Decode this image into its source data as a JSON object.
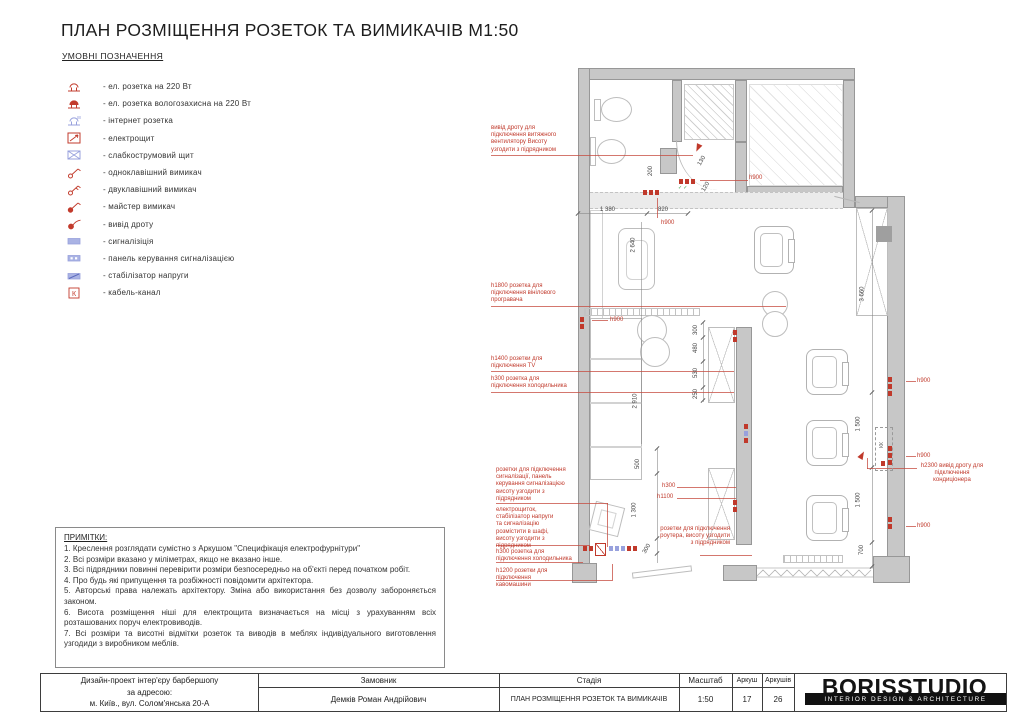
{
  "title": "ПЛАН РОЗМІЩЕННЯ РОЗЕТОК ТА ВИМИКАЧІВ М1:50",
  "legend": {
    "title": "УМОВНІ ПОЗНАЧЕННЯ",
    "items": [
      {
        "icon": "socket-220-icon",
        "label": "- ел. розетка на 220 Вт"
      },
      {
        "icon": "socket-waterproof-icon",
        "label": "- ел. розетка вологозахисна на 220 Вт"
      },
      {
        "icon": "internet-socket-icon",
        "label": "- інтернет розетка"
      },
      {
        "icon": "electrical-panel-icon",
        "label": "- електрощит"
      },
      {
        "icon": "low-current-panel-icon",
        "label": "- слабкострумовий щит"
      },
      {
        "icon": "single-switch-icon",
        "label": "- одноклавішний вимикач"
      },
      {
        "icon": "double-switch-icon",
        "label": "- двуклавішний вимикач"
      },
      {
        "icon": "master-switch-icon",
        "label": "- майстер вимикач"
      },
      {
        "icon": "wire-outlet-icon",
        "label": "- вивід дроту"
      },
      {
        "icon": "alarm-icon",
        "label": "- сигналізіція"
      },
      {
        "icon": "alarm-control-panel-icon",
        "label": "- панель керування сигналізацією"
      },
      {
        "icon": "voltage-stabilizer-icon",
        "label": "- стабілізатор напруги"
      },
      {
        "icon": "cable-channel-icon",
        "label": "- кабель-канал"
      }
    ]
  },
  "notes": {
    "title": "ПРИМІТКИ:",
    "lines": [
      "1. Креслення розглядати сумістно з Аркушом \"Специфікація електрофурнітури\"",
      "2. Всі розміри вказано у міліметрах, якщо не вказано інше.",
      "3. Всі підрядники повинні перевірити розміри безпосередньо на об'єкті перед початком робіт.",
      "4. Про будь які припущення та розбіжності повідомити архітектора.",
      "5. Авторські права належать архітектору. Зміна або використання без дозволу забороняється законом.",
      "6. Висота розміщення ніші для електрощита визначається на місці з урахуванням всіх розташованих поруч електровиводів.",
      "7. Всі розміри та висотні відмітки розеток та виводів в меблях індивідуального виготовлення узгодиди з виробником меблів."
    ]
  },
  "plan": {
    "accent_red": "#c0392b",
    "accent_blue": "#98a1dd",
    "kk_label": "КК",
    "dim_labels": [
      {
        "t": "1 380",
        "x": 600,
        "y": 207,
        "r": 0
      },
      {
        "t": "820",
        "x": 658,
        "y": 207,
        "r": 0
      },
      {
        "t": "200",
        "x": 646,
        "y": 168,
        "r": -90
      },
      {
        "t": "130",
        "x": 697,
        "y": 158,
        "r": -60
      },
      {
        "t": "120",
        "x": 701,
        "y": 184,
        "r": -60
      },
      {
        "t": "2 640",
        "x": 626,
        "y": 242,
        "r": -90
      },
      {
        "t": "2 910",
        "x": 628,
        "y": 398,
        "r": -90
      },
      {
        "t": "300",
        "x": 691,
        "y": 327,
        "r": -90
      },
      {
        "t": "480",
        "x": 691,
        "y": 345,
        "r": -90
      },
      {
        "t": "530",
        "x": 691,
        "y": 370,
        "r": -90
      },
      {
        "t": "250",
        "x": 691,
        "y": 391,
        "r": -90
      },
      {
        "t": "500",
        "x": 633,
        "y": 461,
        "r": -90
      },
      {
        "t": "1 300",
        "x": 627,
        "y": 507,
        "r": -90
      },
      {
        "t": "300",
        "x": 642,
        "y": 546,
        "r": -60
      },
      {
        "t": "3 660",
        "x": 855,
        "y": 291,
        "r": -90
      },
      {
        "t": "1 500",
        "x": 851,
        "y": 421,
        "r": -90
      },
      {
        "t": "1 500",
        "x": 851,
        "y": 497,
        "r": -90
      },
      {
        "t": "700",
        "x": 857,
        "y": 547,
        "r": -90
      }
    ],
    "red_labels": [
      {
        "t": "h900",
        "x": 749,
        "y": 175
      },
      {
        "t": "h900",
        "x": 661,
        "y": 220
      },
      {
        "t": "h900",
        "x": 610,
        "y": 317
      },
      {
        "t": "h900",
        "x": 917,
        "y": 378
      },
      {
        "t": "h900",
        "x": 917,
        "y": 453
      },
      {
        "t": "h900",
        "x": 917,
        "y": 523
      },
      {
        "t": "h300",
        "x": 662,
        "y": 483
      },
      {
        "t": "h1100",
        "x": 657,
        "y": 494
      }
    ],
    "annotations": [
      {
        "t": "вивід дроту для підключення витяжного вентилятору Висоту узгодити з підрядником",
        "x": 491,
        "y": 125,
        "w": 80,
        "a": "left"
      },
      {
        "t": "h1800 розетка для підключення вінілового програвача",
        "x": 491,
        "y": 283,
        "w": 75,
        "a": "left"
      },
      {
        "t": "h1400 розетки для підключення TV",
        "x": 491,
        "y": 356,
        "w": 75,
        "a": "left"
      },
      {
        "t": "h300 розетка для підключення холодильника",
        "x": 491,
        "y": 376,
        "w": 79,
        "a": "left"
      },
      {
        "t": "розетки для підключення сигналізації, панель керування сигналізацією висоту узгодити з підрядником",
        "x": 496,
        "y": 467,
        "w": 70,
        "a": "left"
      },
      {
        "t": "електрощиток, стабілізатор напруги та сигналізацію розмістити в шафі, висоту узгодити з підрядником",
        "x": 496,
        "y": 507,
        "w": 62,
        "a": "left"
      },
      {
        "t": "h300 розетка для підключення холодильника",
        "x": 496,
        "y": 549,
        "w": 79,
        "a": "left"
      },
      {
        "t": "h1200 розетки для підключення кавомашини",
        "x": 496,
        "y": 568,
        "w": 68,
        "a": "left"
      },
      {
        "t": "розетки для підключення роутера, висоту узгодити з підрядником",
        "x": 656,
        "y": 526,
        "w": 74,
        "a": "right"
      },
      {
        "t": "h2300 вивід дроту для підключення кондиціонера",
        "x": 920,
        "y": 463,
        "w": 64,
        "a": "center"
      }
    ],
    "leaders": [
      {
        "x": 491,
        "y": 155,
        "w": 202
      },
      {
        "x": 700,
        "y": 180,
        "w": 48
      },
      {
        "x": 657,
        "y": 198,
        "h": 20
      },
      {
        "x": 592,
        "y": 320,
        "w": 16
      },
      {
        "x": 491,
        "y": 306,
        "w": 295
      },
      {
        "x": 491,
        "y": 371,
        "w": 243
      },
      {
        "x": 491,
        "y": 392,
        "w": 243
      },
      {
        "x": 496,
        "y": 503,
        "w": 112
      },
      {
        "x": 607,
        "y": 503,
        "h": 44
      },
      {
        "x": 496,
        "y": 545,
        "w": 93
      },
      {
        "x": 589,
        "y": 545,
        "h": 6
      },
      {
        "x": 496,
        "y": 562,
        "w": 87
      },
      {
        "x": 496,
        "y": 580,
        "w": 117
      },
      {
        "x": 612,
        "y": 564,
        "h": 16
      },
      {
        "x": 677,
        "y": 487,
        "w": 59
      },
      {
        "x": 677,
        "y": 498,
        "w": 59
      },
      {
        "x": 700,
        "y": 555,
        "w": 52
      },
      {
        "x": 906,
        "y": 381,
        "w": 10
      },
      {
        "x": 906,
        "y": 456,
        "w": 10
      },
      {
        "x": 906,
        "y": 526,
        "w": 10
      },
      {
        "x": 867,
        "y": 468,
        "w": 50
      },
      {
        "x": 867,
        "y": 458,
        "h": 11
      }
    ],
    "dim_lines": [
      {
        "x": 578,
        "y": 213,
        "w": 110
      },
      {
        "x": 703,
        "y": 322,
        "h": 80
      },
      {
        "x": 872,
        "y": 210,
        "h": 358
      },
      {
        "x": 657,
        "y": 448,
        "h": 115
      },
      {
        "x": 641,
        "y": 222,
        "h": 222
      }
    ],
    "ticks": [
      {
        "x": 578,
        "y": 213
      },
      {
        "x": 647,
        "y": 213
      },
      {
        "x": 688,
        "y": 213
      },
      {
        "x": 703,
        "y": 322
      },
      {
        "x": 703,
        "y": 337
      },
      {
        "x": 703,
        "y": 361
      },
      {
        "x": 703,
        "y": 387
      },
      {
        "x": 703,
        "y": 400
      },
      {
        "x": 872,
        "y": 210
      },
      {
        "x": 872,
        "y": 392
      },
      {
        "x": 872,
        "y": 467
      },
      {
        "x": 872,
        "y": 542
      },
      {
        "x": 872,
        "y": 566
      },
      {
        "x": 657,
        "y": 448
      },
      {
        "x": 657,
        "y": 473
      },
      {
        "x": 657,
        "y": 538
      },
      {
        "x": 657,
        "y": 553
      }
    ],
    "symbols": [
      {
        "k": "r3h",
        "x": 679,
        "y": 179
      },
      {
        "k": "g2",
        "x": 678,
        "y": 185
      },
      {
        "k": "r3h",
        "x": 643,
        "y": 190
      },
      {
        "k": "arr",
        "x": 694,
        "y": 145,
        "r": 115
      },
      {
        "k": "r2v",
        "x": 580,
        "y": 317
      },
      {
        "k": "r2v",
        "x": 733,
        "y": 330
      },
      {
        "k": "m3v",
        "x": 744,
        "y": 424
      },
      {
        "k": "r2v",
        "x": 733,
        "y": 500
      },
      {
        "k": "r3v",
        "x": 888,
        "y": 377
      },
      {
        "k": "r3v",
        "x": 888,
        "y": 446
      },
      {
        "k": "r2v",
        "x": 888,
        "y": 517
      },
      {
        "k": "arr",
        "x": 858,
        "y": 452,
        "r": -60
      },
      {
        "k": "cluster",
        "x": 583,
        "y": 545
      },
      {
        "k": "kk",
        "x": 875,
        "y": 427
      }
    ]
  },
  "titleblock": {
    "project_lines": [
      "Дизайн-проект інтер'єру барбершопу",
      "за адресою:",
      "м. Київ., вул. Солом'янська 20-А"
    ],
    "customer_label": "Замовник",
    "customer_value": "Демків Роман Андрійович",
    "stage_label": "Стадія",
    "stage_value": "ПЛАН РОЗМІЩЕННЯ РОЗЕТОК ТА ВИМИКАЧІВ",
    "scale_label": "Масштаб",
    "scale_value": "1:50",
    "sheet_label": "Аркуш",
    "sheet_value": "17",
    "sheets_label": "Аркушів",
    "sheets_value": "26",
    "logo": "BORISSTUDIO",
    "logo_sub": "INTERIOR DESIGN & ARCHITECTURE"
  }
}
